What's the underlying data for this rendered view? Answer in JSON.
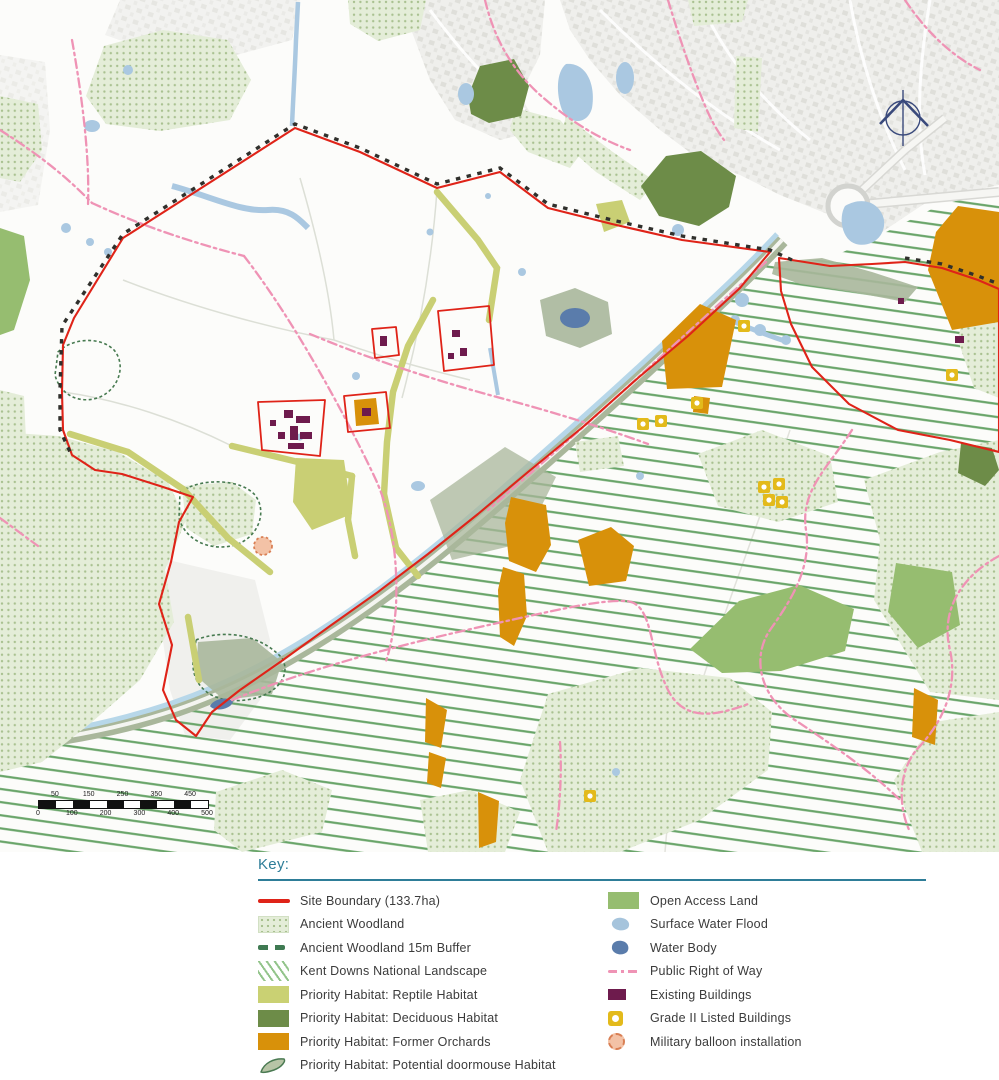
{
  "key": {
    "title": "Key:",
    "left": [
      {
        "label": "Site Boundary (133.7ha)",
        "swatch": "site-boundary",
        "color": "#df2318"
      },
      {
        "label": "Ancient Woodland",
        "swatch": "ancient-woodland",
        "color": "#e4edd8"
      },
      {
        "label": "Ancient Woodland 15m Buffer",
        "swatch": "woodland-buffer-dash",
        "color": "#3f7a52"
      },
      {
        "label": "Kent Downs National Landscape",
        "swatch": "diagonal-hatch",
        "color": "#68a468"
      },
      {
        "label": "Priority Habitat: Reptile Habitat",
        "swatch": "fill",
        "color": "#cad173"
      },
      {
        "label": "Priority Habitat: Deciduous Habitat",
        "swatch": "fill",
        "color": "#6d8c48"
      },
      {
        "label": "Priority Habitat: Former Orchards",
        "swatch": "fill",
        "color": "#d8910a"
      },
      {
        "label": "Priority Habitat: Potential doormouse Habitat",
        "swatch": "outlined-blob",
        "color": "#4a7a52"
      }
    ],
    "right": [
      {
        "label": "Open Access Land",
        "swatch": "fill",
        "color": "#96bd70"
      },
      {
        "label": "Surface Water Flood",
        "swatch": "blob",
        "color": "#a6c4dc"
      },
      {
        "label": "Water Body",
        "swatch": "blob",
        "color": "#5a7cab"
      },
      {
        "label": "Public Right of Way",
        "swatch": "pink-dash-dot",
        "color": "#ef93b5"
      },
      {
        "label": "Existing Buildings",
        "swatch": "fill-small",
        "color": "#6e1b4d"
      },
      {
        "label": "Grade II Listed Buildings",
        "swatch": "listed-marker",
        "color": "#e3ba1b"
      },
      {
        "label": "Military balloon installation",
        "swatch": "dotted-circle",
        "color": "#f3c2a6"
      }
    ]
  },
  "map": {
    "scale_bar": {
      "labels_top": [
        "50",
        "150",
        "250",
        "350",
        "450"
      ],
      "labels_bottom": [
        "0",
        "100",
        "200",
        "300",
        "400",
        "500"
      ]
    },
    "icons": [
      "north-arrow-icon"
    ]
  },
  "colors": {
    "key_accent": "#2e7d98",
    "site_boundary": "#df2318",
    "buffer_dash_map": "#30302c",
    "kent_downs_hatch": "#68a468",
    "ancient_woodland_fill": "#e4edd8",
    "ancient_woodland_dot": "#a9c190",
    "reptile_habitat": "#cad173",
    "deciduous_habitat": "#6d8c48",
    "former_orchards": "#d8910a",
    "open_access_land": "#96bd70",
    "surface_water_flood": "#a6c4dc",
    "water_body": "#5a7cab",
    "public_right_of_way": "#ef93b5",
    "existing_buildings": "#6e1b4d",
    "grade_ii_listed": "#e3ba1b",
    "military_balloon": "#f3c2a6"
  }
}
